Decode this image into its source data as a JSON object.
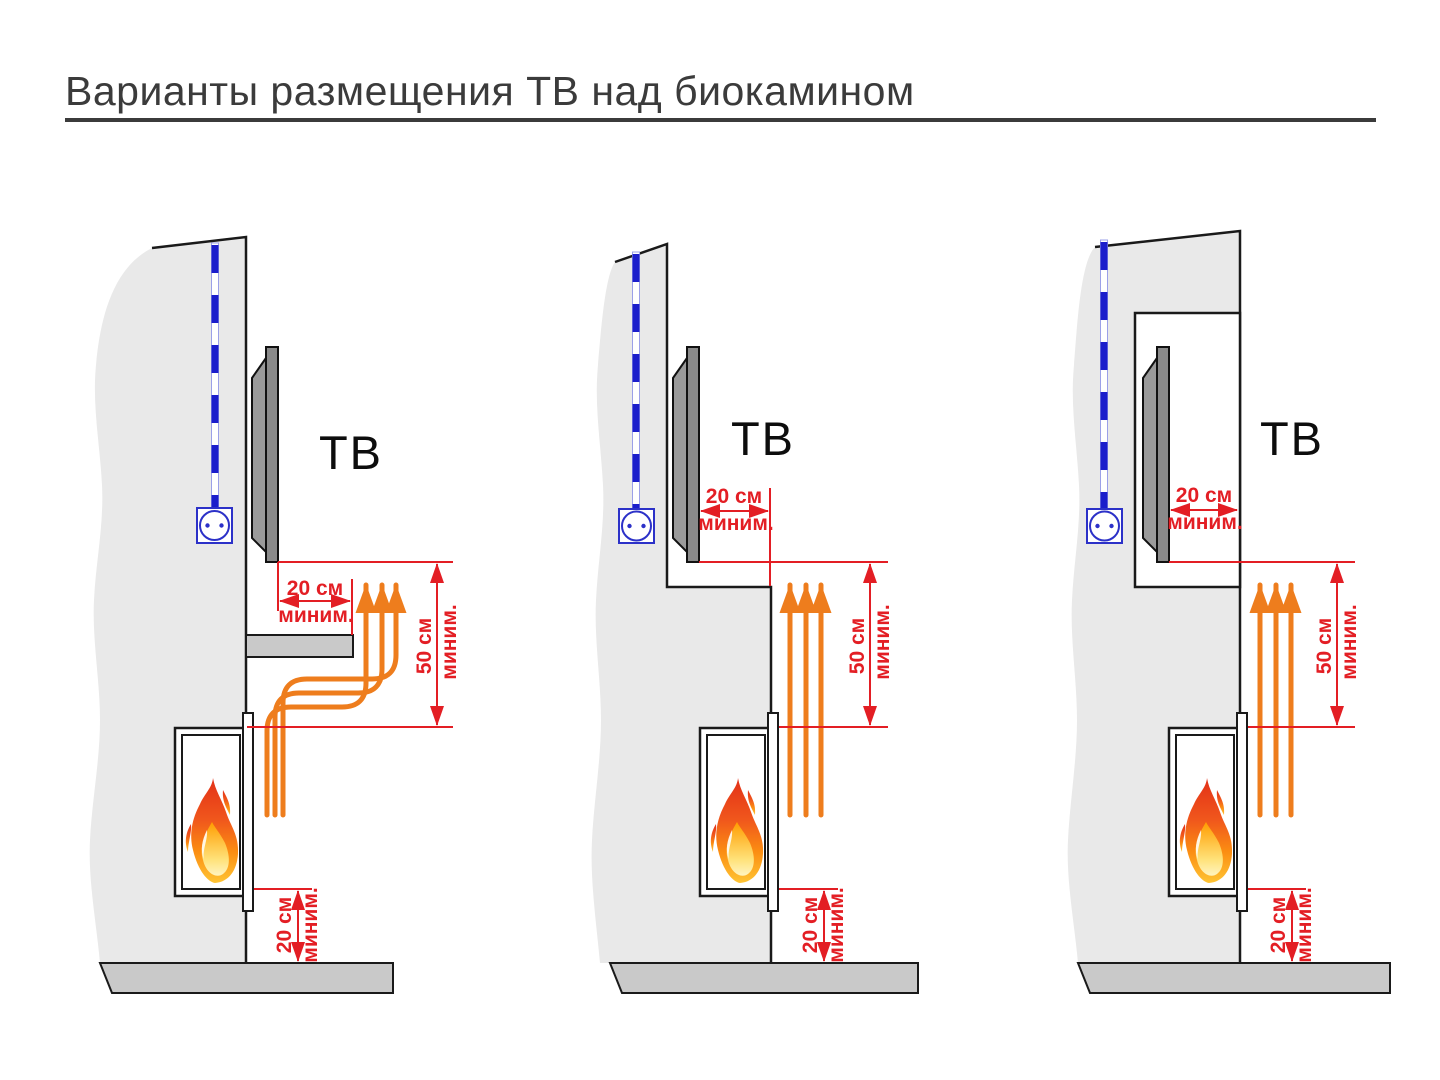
{
  "title": "Варианты размещения ТВ над биокамином",
  "labels": {
    "tv": "ТВ"
  },
  "dimensions": {
    "side_clearance": {
      "value": "20 см",
      "qualifier": "миним."
    },
    "vertical_clearance": {
      "value": "50 см",
      "qualifier": "миним."
    },
    "floor_clearance": {
      "value": "20 см",
      "qualifier": "миним."
    }
  },
  "colors": {
    "dimension_red": "#e31e24",
    "heat_orange": "#ee7d1d",
    "cable_blue": "#1b1ecb",
    "outlet_blue": "#2c31c8",
    "wall_gray": "#e9e9e9",
    "surface_gray": "#c9c9c9",
    "tv_gray": "#8a8a8a",
    "outline_black": "#1a1a1a",
    "title_color": "#3b3b3b"
  }
}
